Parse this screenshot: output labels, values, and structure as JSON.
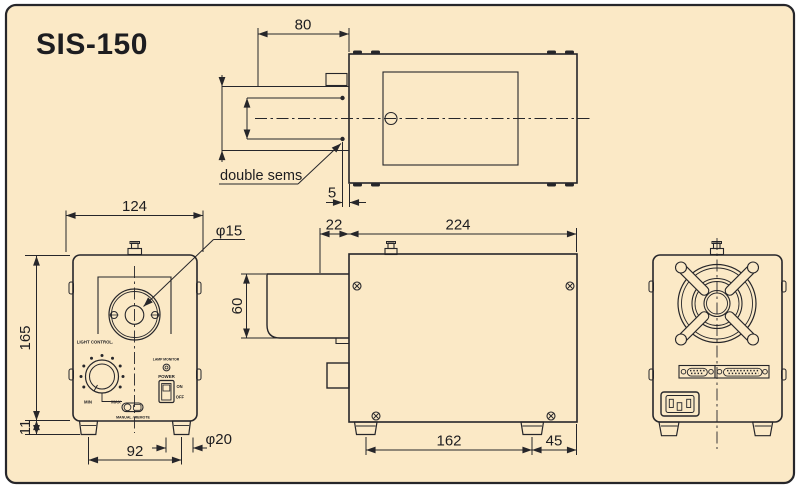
{
  "title": "SIS-150",
  "annotations": {
    "double_sems": "double sems"
  },
  "dims": {
    "d80": "80",
    "d5": "5",
    "d124": "124",
    "phi15": "φ15",
    "d165": "165",
    "d11": "11",
    "d92": "92",
    "phi20": "φ20",
    "d22": "22",
    "d224": "224",
    "d60": "60",
    "d162": "162",
    "d45": "45"
  },
  "front_panel": {
    "light_control": "LIGHT CONTROL.",
    "min": "MIN",
    "max": "MAX",
    "mode": "MANUAL / REMOTE",
    "lamp_monitor": "LAMP MONITOR",
    "power": "POWER",
    "on": "ON",
    "off": "OFF"
  },
  "colors": {
    "paper": "#FBE9C6",
    "ink": "#26262a",
    "border": "#26262a"
  }
}
